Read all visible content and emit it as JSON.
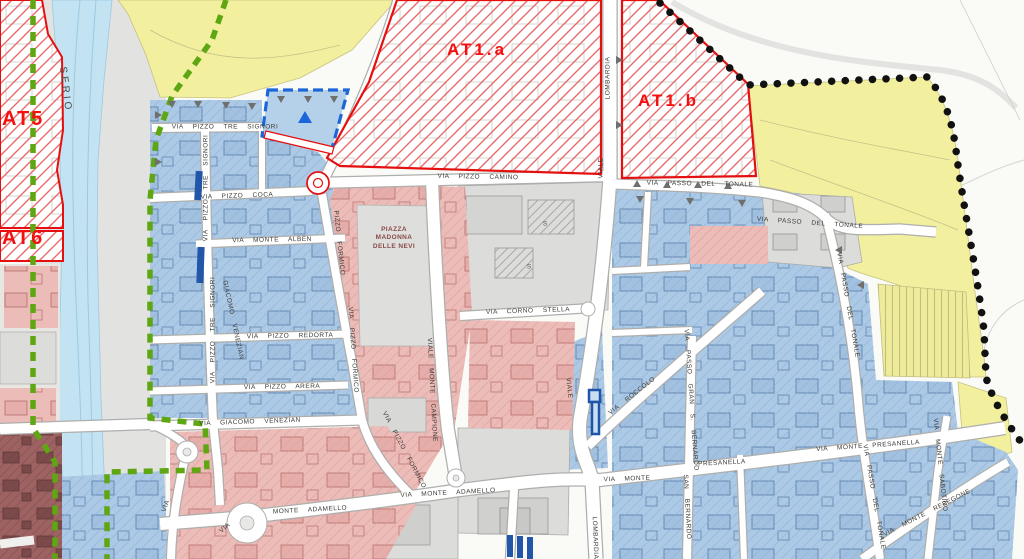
{
  "map": {
    "zones": {
      "at5": {
        "label": "AT5"
      },
      "at6": {
        "label": "AT6"
      },
      "at1a": {
        "label": "AT1.a"
      },
      "at1b": {
        "label": "AT1.b"
      }
    },
    "river": {
      "label": "SERIO"
    },
    "piazza": {
      "line1": "PIAZZA",
      "line2": "MADONNA",
      "line3": "DELLE NEVI"
    },
    "street_labels": [
      {
        "text": "VIA PIZZO TRE SIGNORI",
        "x": 225,
        "y": 127,
        "rot": 0
      },
      {
        "text": "VIA PIZZO TRE SIGNORI",
        "x": 206,
        "y": 188,
        "rot": -90
      },
      {
        "text": "VIA PIZZO TRE SIGNORI",
        "x": 213,
        "y": 330,
        "rot": -90
      },
      {
        "text": "VIA PIZZO COCA",
        "x": 237,
        "y": 196,
        "rot": -2
      },
      {
        "text": "VIA PIZZO CAMINO",
        "x": 478,
        "y": 177,
        "rot": 1
      },
      {
        "text": "LOMBARDIA",
        "x": 608,
        "y": 78,
        "rot": -90
      },
      {
        "text": "VIALE",
        "x": 601,
        "y": 168,
        "rot": -90
      },
      {
        "text": "VIA PASSO DEL TONALE",
        "x": 700,
        "y": 184,
        "rot": 1
      },
      {
        "text": "VIA PASSO DEL TONALE",
        "x": 810,
        "y": 223,
        "rot": 4
      },
      {
        "text": "VIA PASSO DEL TONALE",
        "x": 848,
        "y": 305,
        "rot": 80
      },
      {
        "text": "VIA PASSO DEL TONALE",
        "x": 874,
        "y": 497,
        "rot": 80
      },
      {
        "text": "VIA MONTE ALBEN",
        "x": 272,
        "y": 240,
        "rot": -1
      },
      {
        "text": "VIA PIZZO REDORTA",
        "x": 290,
        "y": 336,
        "rot": -1
      },
      {
        "text": "VIA PIZZO ARERA",
        "x": 282,
        "y": 387,
        "rot": -1
      },
      {
        "text": "VIA GIACOMO VENEZIAN",
        "x": 250,
        "y": 422,
        "rot": -2
      },
      {
        "text": "GIACOMO VENEZIAN",
        "x": 233,
        "y": 320,
        "rot": 78
      },
      {
        "text": "PIZZO FORMICO",
        "x": 339,
        "y": 243,
        "rot": 84
      },
      {
        "text": "VIA PIZZO FORMICO",
        "x": 353,
        "y": 350,
        "rot": 86
      },
      {
        "text": "VIA PIZZO FORMICO",
        "x": 404,
        "y": 450,
        "rot": 62
      },
      {
        "text": "VIALE MONTE CAMPIONE",
        "x": 432,
        "y": 390,
        "rot": 87
      },
      {
        "text": "VIA CORNO STELLA",
        "x": 528,
        "y": 311,
        "rot": -2
      },
      {
        "text": "VIALE",
        "x": 569,
        "y": 388,
        "rot": 84
      },
      {
        "text": "LOMBARDIA",
        "x": 595,
        "y": 538,
        "rot": 88
      },
      {
        "text": "VIA ROCCOLO",
        "x": 632,
        "y": 396,
        "rot": -38
      },
      {
        "text": "VIA",
        "x": 166,
        "y": 506,
        "rot": -70
      },
      {
        "text": "MONTE ADAMELLO",
        "x": 310,
        "y": 510,
        "rot": -3
      },
      {
        "text": "VIA MONTE ADAMELLO",
        "x": 448,
        "y": 493,
        "rot": -3
      },
      {
        "text": "VIA MONTE",
        "x": 627,
        "y": 479,
        "rot": -2
      },
      {
        "text": "PRESANELLA",
        "x": 722,
        "y": 463,
        "rot": -3
      },
      {
        "text": "VIA MONTE PRESANELLA",
        "x": 868,
        "y": 446,
        "rot": -4
      },
      {
        "text": "VIA PASSO GRAN S. BERNARDO",
        "x": 691,
        "y": 400,
        "rot": 86
      },
      {
        "text": "SAN BERNARDO",
        "x": 687,
        "y": 507,
        "rot": 87
      },
      {
        "text": "VIA MONTE SABOTINO",
        "x": 940,
        "y": 465,
        "rot": 84
      },
      {
        "text": "VIA MONTE RESEGONE",
        "x": 927,
        "y": 513,
        "rot": -27
      },
      {
        "text": "VIA",
        "x": 225,
        "y": 528,
        "rot": -42
      }
    ],
    "building_marks": [
      {
        "text": "S",
        "x": 545,
        "y": 224
      },
      {
        "text": "S",
        "x": 529,
        "y": 267
      }
    ],
    "colors": {
      "at_zone_border": "#E60F0F",
      "at_label_red": "#F50F0F",
      "residential_blue": "#ACCAE6",
      "historic_pink": "#ECBCB8",
      "public_gray": "#DCDCDA",
      "agricultural_yellow": "#F2F09F",
      "olive_zone": "#D6D28C",
      "river_blue": "#C3E3F2",
      "boundary_green_dash": "#5EA612",
      "boundary_black_dots": "#111111",
      "boundary_blue_dash": "#1B66D9",
      "special_building_blue": "#2156A8",
      "dark_red_zone": "#9E6262"
    }
  }
}
